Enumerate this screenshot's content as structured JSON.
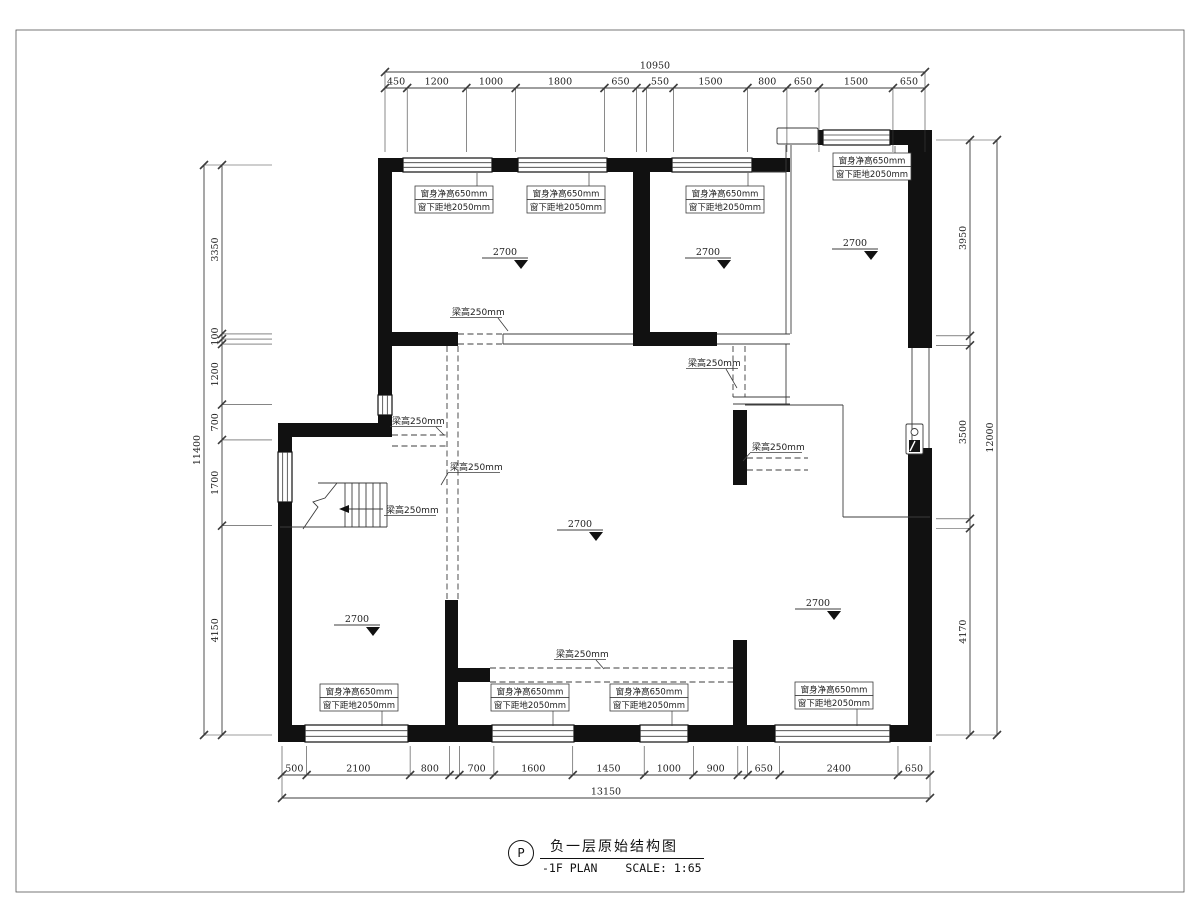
{
  "title_block": {
    "bubble": "P",
    "title": "负一层原始结构图",
    "plan_name": "-1F PLAN",
    "scale": "SCALE: 1:65"
  },
  "text": {
    "window_label_line1": "窗身净高650mm",
    "window_label_line2": "窗下距地2050mm",
    "beam_label": "梁高250mm",
    "level_value": "2700"
  },
  "colors": {
    "wall": "#111111",
    "thin": "#3c3c3c",
    "dim": "#222222",
    "leader": "#555555"
  },
  "dimensions": {
    "top": {
      "orient": "h",
      "line": 88,
      "total_line": 72,
      "start": 385,
      "end": 925,
      "ext_to": 152,
      "values": [
        450,
        1200,
        1000,
        1800,
        650,
        200,
        550,
        1500,
        800,
        650,
        1500,
        650
      ],
      "labels": [
        "450",
        "1200",
        "1000",
        "1800",
        "650",
        "",
        "550",
        "1500",
        "800",
        "650",
        "1500",
        "650"
      ],
      "total": "10950"
    },
    "bottom": {
      "orient": "h",
      "line": 775,
      "total_line": 798,
      "start": 282,
      "end": 930,
      "ext_to": 746,
      "values": [
        500,
        2100,
        800,
        200,
        700,
        1600,
        1450,
        1000,
        900,
        200,
        650,
        2400,
        650
      ],
      "labels": [
        "500",
        "2100",
        "800",
        "",
        "700",
        "1600",
        "1450",
        "1000",
        "900",
        "",
        "650",
        "2400",
        "650"
      ],
      "total": "13150"
    },
    "left": {
      "orient": "v",
      "line": 222,
      "total_line": 204,
      "start": 165,
      "end": 735,
      "ext_to": 272,
      "values": [
        3350,
        100,
        100,
        1200,
        700,
        1700,
        4150
      ],
      "labels": [
        "3350",
        "100",
        "",
        "1200",
        "700",
        "1700",
        "4150"
      ],
      "total": "11400"
    },
    "right": {
      "orient": "v",
      "line": 970,
      "total_line": 997,
      "start": 140,
      "end": 735,
      "ext_to": 936,
      "values": [
        3950,
        190,
        3500,
        190,
        4170
      ],
      "labels": [
        "3950",
        "",
        "3500",
        "",
        "4170"
      ],
      "total": "12000"
    }
  },
  "plan": {
    "border": [
      16,
      30,
      1168,
      862
    ],
    "walls": [
      [
        378,
        158,
        412,
        14
      ],
      [
        818,
        130,
        114,
        15
      ],
      [
        908,
        130,
        24,
        218
      ],
      [
        908,
        448,
        24,
        294
      ],
      [
        378,
        172,
        14,
        265
      ],
      [
        278,
        423,
        112,
        14
      ],
      [
        278,
        437,
        14,
        305
      ],
      [
        278,
        725,
        654,
        17
      ],
      [
        633,
        172,
        17,
        162
      ],
      [
        378,
        332,
        80,
        14
      ],
      [
        633,
        332,
        84,
        14
      ],
      [
        445,
        600,
        13,
        127
      ],
      [
        458,
        668,
        32,
        14
      ],
      [
        733,
        410,
        14,
        75
      ],
      [
        733,
        640,
        14,
        87
      ]
    ],
    "windows": [
      [
        403,
        158,
        89,
        14
      ],
      [
        518,
        158,
        89,
        14
      ],
      [
        672,
        158,
        80,
        14
      ],
      [
        823,
        130,
        67,
        15
      ],
      [
        378,
        395,
        14,
        20
      ],
      [
        278,
        452,
        14,
        50
      ],
      [
        305,
        725,
        103,
        17
      ],
      [
        492,
        725,
        82,
        17
      ],
      [
        640,
        725,
        48,
        17
      ],
      [
        775,
        725,
        115,
        17
      ]
    ],
    "thin_rects": [
      [
        777,
        128,
        41,
        16
      ],
      [
        906,
        424,
        17,
        30
      ]
    ],
    "thin_lines": [
      [
        786,
        145,
        786,
        334
      ],
      [
        791,
        145,
        791,
        334
      ],
      [
        752,
        172,
        786,
        172
      ],
      [
        503,
        334,
        633,
        334
      ],
      [
        503,
        344,
        633,
        344
      ],
      [
        503,
        334,
        503,
        344
      ],
      [
        717,
        334,
        790,
        334
      ],
      [
        717,
        344,
        790,
        344
      ],
      [
        733,
        397,
        790,
        397
      ],
      [
        733,
        404,
        790,
        404
      ],
      [
        786,
        344,
        786,
        404
      ],
      [
        745,
        405,
        843,
        405
      ],
      [
        843,
        405,
        843,
        517
      ],
      [
        843,
        517,
        930,
        517
      ],
      [
        318,
        483,
        387,
        483
      ],
      [
        280,
        527,
        387,
        527
      ],
      [
        387,
        483,
        387,
        527
      ],
      [
        912,
        348,
        912,
        448
      ],
      [
        929,
        348,
        929,
        448
      ]
    ],
    "dashed_lines": [
      [
        458,
        334,
        503,
        334
      ],
      [
        458,
        344,
        503,
        344
      ],
      [
        447,
        346,
        447,
        600
      ],
      [
        458,
        346,
        458,
        600
      ],
      [
        392,
        435,
        447,
        435
      ],
      [
        392,
        446,
        447,
        446
      ],
      [
        733,
        346,
        733,
        397
      ],
      [
        745,
        346,
        745,
        397
      ],
      [
        747,
        458,
        808,
        458
      ],
      [
        747,
        470,
        808,
        470
      ],
      [
        490,
        668,
        733,
        668
      ],
      [
        490,
        682,
        733,
        682
      ]
    ],
    "stair": {
      "treads_x": [
        345,
        352,
        359,
        366,
        373,
        380
      ],
      "tread_y0": 483,
      "tread_y1": 527,
      "arrow": [
        383,
        509,
        347,
        509
      ],
      "break": [
        303,
        529,
        318,
        507,
        313,
        502,
        325,
        498,
        337,
        483
      ]
    },
    "fixture": {
      "circle": [
        914.5,
        432,
        3.5
      ],
      "dark": [
        909,
        440,
        11,
        12
      ]
    },
    "levels": [
      [
        505,
        255
      ],
      [
        708,
        255
      ],
      [
        855,
        246
      ],
      [
        580,
        527
      ],
      [
        357,
        622
      ],
      [
        818,
        606
      ]
    ],
    "window_labels": [
      {
        "x": 415,
        "y": 186,
        "leader": [
          477,
          186,
          477,
          173
        ]
      },
      {
        "x": 527,
        "y": 186,
        "leader": [
          589,
          186,
          589,
          173
        ]
      },
      {
        "x": 686,
        "y": 186,
        "leader": [
          748,
          186,
          748,
          173
        ]
      },
      {
        "x": 833,
        "y": 153,
        "leader": [
          895,
          153,
          895,
          146
        ]
      },
      {
        "x": 320,
        "y": 684,
        "leader": [
          382,
          711,
          382,
          726
        ]
      },
      {
        "x": 491,
        "y": 684,
        "leader": [
          553,
          711,
          553,
          726
        ]
      },
      {
        "x": 610,
        "y": 684,
        "leader": [
          672,
          711,
          672,
          726
        ]
      },
      {
        "x": 795,
        "y": 682,
        "leader": [
          857,
          709,
          857,
          726
        ]
      }
    ],
    "beam_labels": [
      {
        "x": 452,
        "y": 315,
        "leader": [
          498,
          318,
          508,
          331
        ]
      },
      {
        "x": 392,
        "y": 424,
        "leader": [
          436,
          427,
          444,
          435
        ]
      },
      {
        "x": 450,
        "y": 470,
        "leader": [
          448,
          473,
          441,
          485
        ]
      },
      {
        "x": 386,
        "y": 513,
        "leader": null
      },
      {
        "x": 688,
        "y": 366,
        "leader": [
          726,
          369,
          737,
          388
        ]
      },
      {
        "x": 752,
        "y": 450,
        "leader": [
          750,
          453,
          743,
          461
        ]
      },
      {
        "x": 556,
        "y": 657,
        "leader": [
          596,
          660,
          604,
          669
        ]
      }
    ]
  }
}
